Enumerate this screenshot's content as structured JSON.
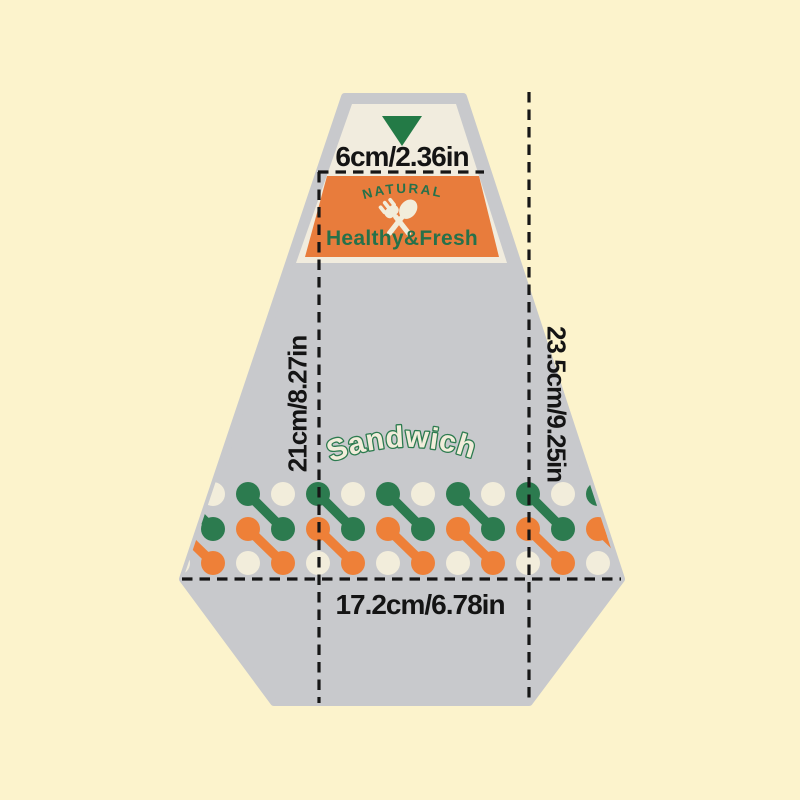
{
  "package": {
    "name": "Sandwich",
    "label": {
      "tagline": "NATURAL",
      "brand": "Healthy&Fresh"
    },
    "icons": {
      "seal": "triangle-down-icon",
      "utensils": "fork-spoon-icon"
    }
  },
  "dimensions": {
    "top_width": "6cm/2.36in",
    "body_height": "21cm/8.27in",
    "total_height": "23.5cm/9.25in",
    "bottom_width": "17.2cm/6.78in"
  },
  "theme": {
    "background": "#FCF3CC",
    "bag_gray": "#C8C9CC",
    "flap_cream": "#F1ECDE",
    "label_orange": "#E87C3C",
    "brand_green": "#26714A",
    "triangle_green": "#237A46",
    "dot_green": "#2C7B4F",
    "dot_orange": "#EE8038",
    "dot_cream": "#F2EDDB",
    "line_black": "#161616"
  }
}
